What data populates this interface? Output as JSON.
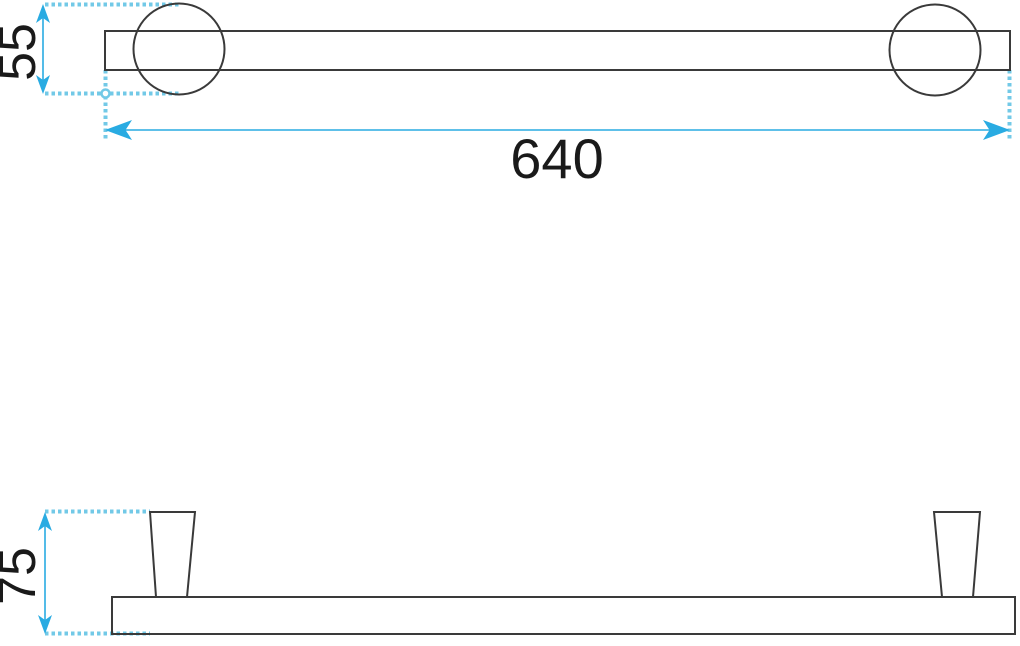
{
  "drawing": {
    "type": "technical-dimension-drawing",
    "views": {
      "top": {
        "length_dimension_label": "640",
        "flange_diameter_dimension_label": "55"
      },
      "front": {
        "post_height_dimension_label": "75"
      }
    }
  },
  "colors": {
    "accent": "#29abe2",
    "dotted": "#72c9e7",
    "outline": "#3a3a3a",
    "text": "#1a1a1a",
    "bg": "#ffffff"
  }
}
